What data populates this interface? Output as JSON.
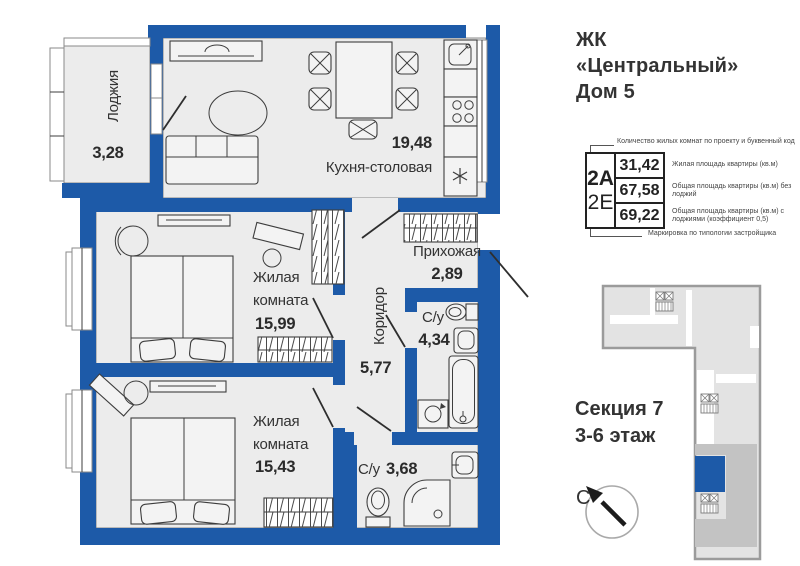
{
  "header": {
    "line1": "ЖК",
    "line2": "«Центральный»",
    "line3": "Дом 5"
  },
  "info_table": {
    "top_note": "Количество жилых комнат по проекту и буквенный код",
    "bottom_note": "Маркировка по типологии застройщика",
    "code_primary": "2А",
    "code_secondary": "2Е",
    "rows": [
      {
        "value": "31,42",
        "label": "Жилая площадь квартиры (кв.м)"
      },
      {
        "value": "67,58",
        "label": "Общая площадь квартиры (кв.м) без лоджий"
      },
      {
        "value": "69,22",
        "label": "Общая площадь квартиры (кв.м) с лоджиями (коэффициент 0,5)"
      }
    ]
  },
  "section_info": {
    "line1": "Секция 7",
    "line2": "3-6 этаж"
  },
  "compass": {
    "north_label": "С"
  },
  "rooms": {
    "loggia": {
      "name": "Лоджия",
      "area": "3,28"
    },
    "kitchen": {
      "name": "Кухня-столовая",
      "area": "19,48"
    },
    "bedroom1": {
      "name_line1": "Жилая",
      "name_line2": "комната",
      "area": "15,99"
    },
    "corridor": {
      "name": "Коридор",
      "area": "5,77"
    },
    "hallway": {
      "name": "Прихожая",
      "area": "2,89"
    },
    "bathroom1": {
      "name": "С/у",
      "area": "4,34"
    },
    "bedroom2": {
      "name_line1": "Жилая",
      "name_line2": "комната",
      "area": "15,43"
    },
    "bathroom2": {
      "name": "С/у",
      "area": "3,68"
    }
  },
  "colors": {
    "wall": "#1d5aa8",
    "room_fill": "#ececec",
    "minimap_highlight": "#1d5aa8"
  }
}
